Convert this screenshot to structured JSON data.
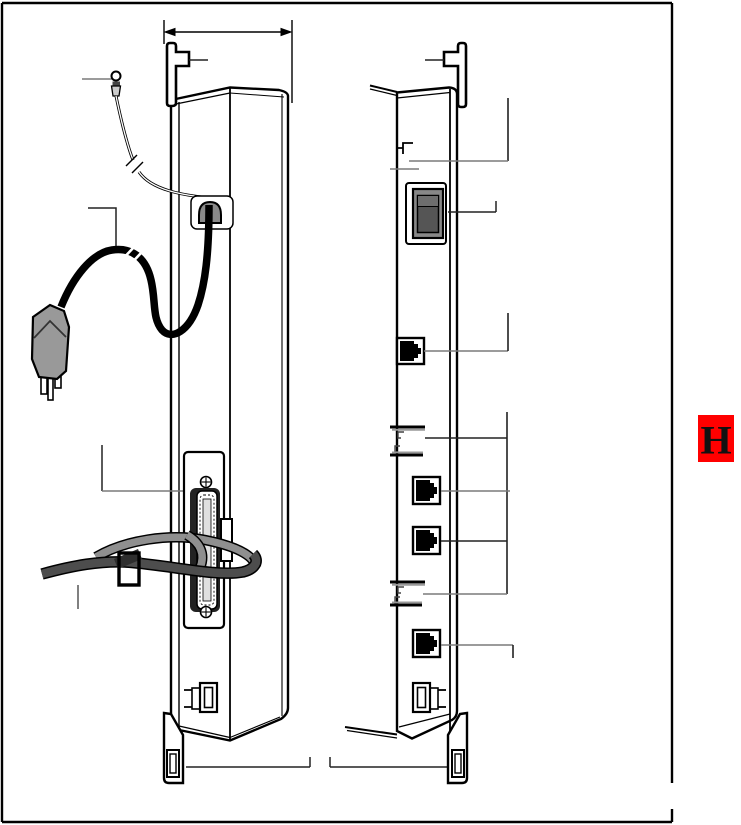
{
  "page": {
    "background": "#ffffff",
    "frame_color": "#000000"
  },
  "section_tab": {
    "label": "H",
    "fill": "#ff0000",
    "text_color": "#111111"
  },
  "figure": {
    "kind": "technical-line-illustration",
    "subject": "two side views of a wall-mounted control unit",
    "left_view": {
      "parts": [
        "mounting-tab",
        "dimension-arrow",
        "ground-wire",
        "power-cord",
        "power-plug",
        "strain-relief",
        "25-pair-connector",
        "connector-screws",
        "cable-strap-light",
        "cable-strap-dark",
        "strap-buckle",
        "bottom-clip",
        "mounting-foot"
      ]
    },
    "right_view": {
      "parts": [
        "mounting-tab",
        "top-edge-detail",
        "power-switch",
        "line-jack-1",
        "cord-hooks-upper",
        "line-jack-2",
        "line-jack-3",
        "cord-hooks-lower",
        "line-jack-4",
        "bottom-clip",
        "mounting-foot"
      ]
    },
    "callouts": {
      "style": "unlabeled leader lines",
      "count": 16
    },
    "colors": {
      "outline": "#000000",
      "leader_gray": "#7a7a7a",
      "leader_dark": "#222222",
      "plug_gray": "#999999",
      "strain_relief_gray": "#8a8a8a",
      "strap_dark": "#4d4d4d",
      "strap_light": "#8f8f8f",
      "switch_frame": "#888888",
      "switch_body": "#555555",
      "connector_channel": "#e0e0e0",
      "ferrule_gray": "#cccccc"
    }
  }
}
